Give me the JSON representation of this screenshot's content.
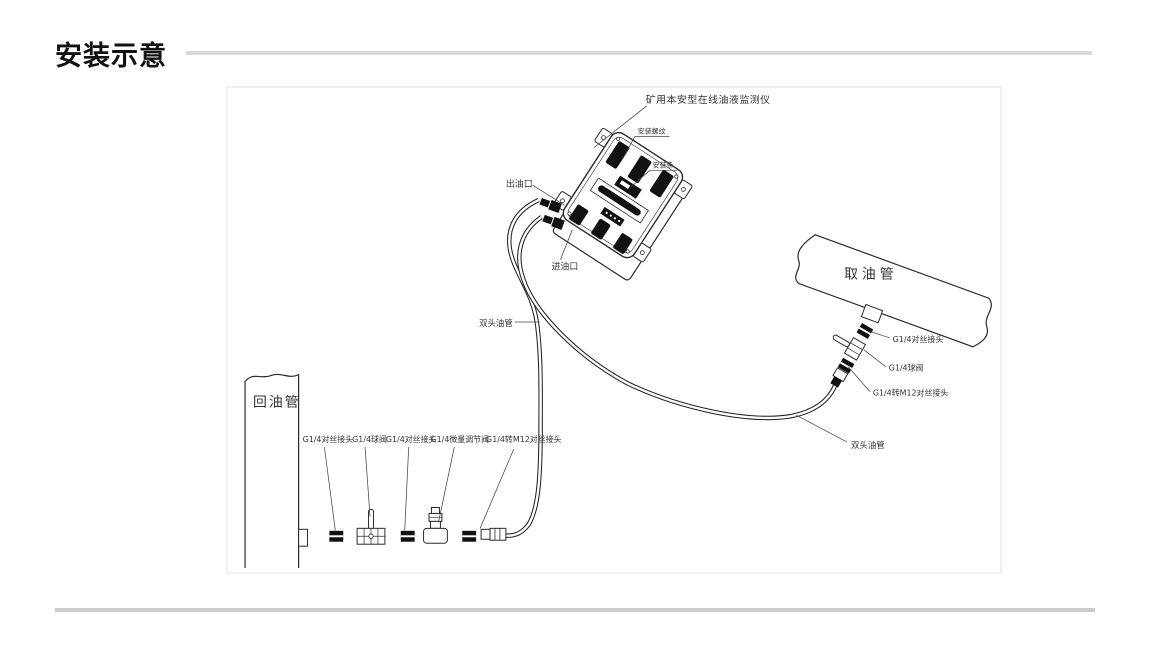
{
  "header": {
    "title": "安装示意"
  },
  "colors": {
    "title_rule": "#d9d9d9",
    "bottom_rule": "#cbcbcb",
    "frame_border": "#f1f1f1",
    "line": "#2a2a2a",
    "label_text": "#333333"
  },
  "diagram": {
    "device": {
      "name_label": "矿用本安型在线油液监测仪",
      "mount_thread_label": "安装螺纹",
      "mount_bar_label": "安装条",
      "outlet_label": "出油口",
      "inlet_label": "进油口"
    },
    "pipes": {
      "intake_pipe": "取油管",
      "return_pipe": "回油管",
      "hose_left": "双头油管",
      "hose_right": "双头油管"
    },
    "right_chain_labels": [
      "G1/4对丝接头",
      "G1/4球阀",
      "G1/4转M12对丝接头"
    ],
    "bottom_chain_labels": [
      "G1/4对丝接头",
      "G1/4球阀",
      "G1/4对丝接头",
      "G1/4微量调节阀",
      "G1/4转M12对丝接头"
    ]
  }
}
